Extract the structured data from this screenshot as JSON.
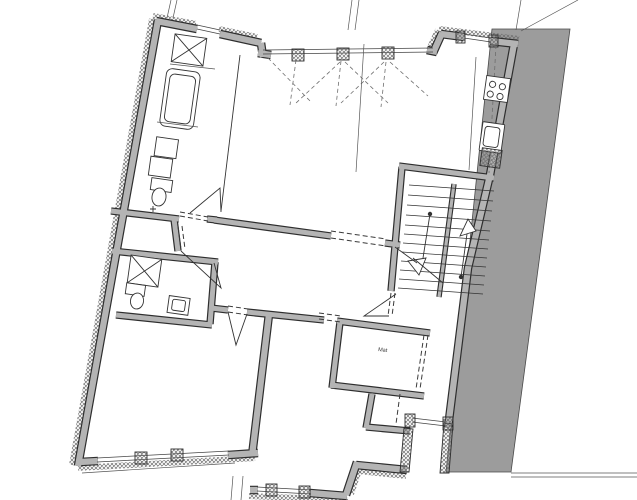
{
  "labels": {
    "pantry": "Mat"
  },
  "colors": {
    "background": "#ffffff",
    "wall": "#b4b4b4",
    "wall_outline": "#2e2e2e",
    "neighbor_fill": "#9c9c9c",
    "hatch": "#6d6d6d",
    "thin_line": "#444444"
  }
}
